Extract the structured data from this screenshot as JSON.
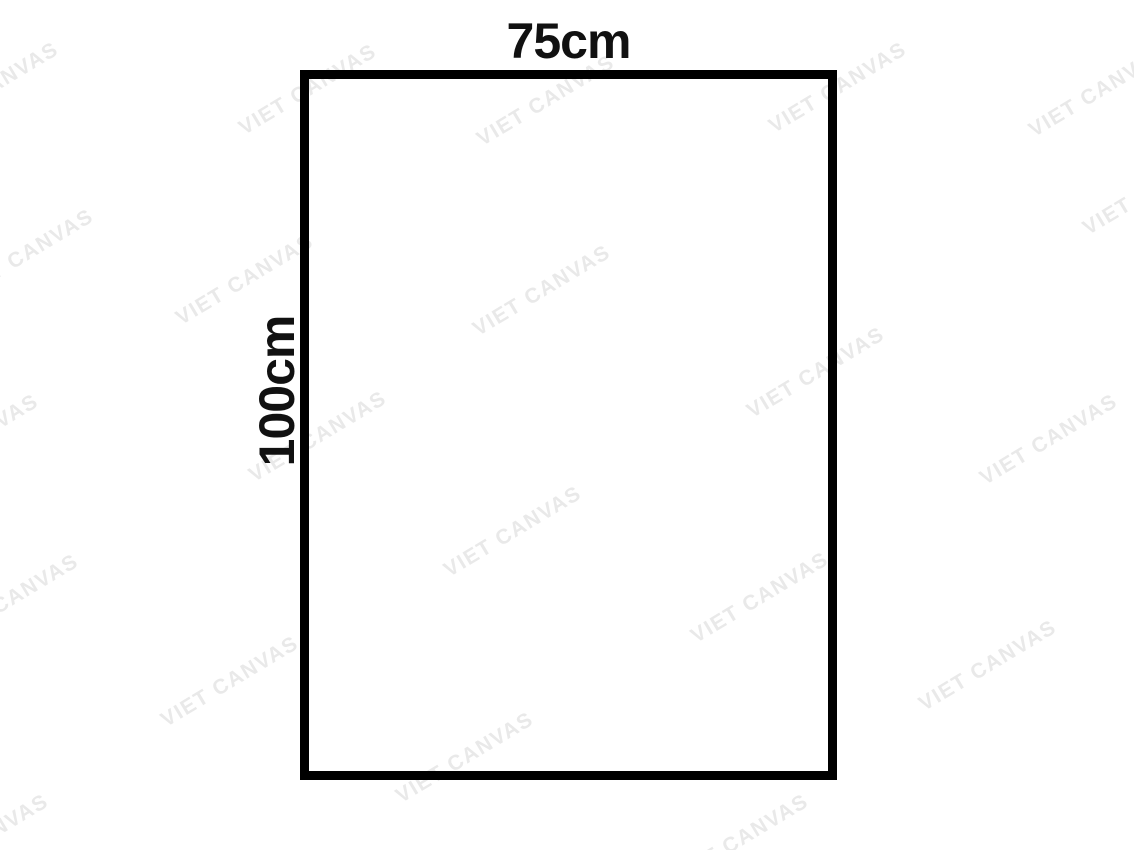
{
  "figure": {
    "type": "rectangle-dimension-diagram",
    "width_label": "75cm",
    "height_label": "100cm"
  },
  "watermark": {
    "text": "VIET CANVAS",
    "color": "#e9e9e9",
    "angle_deg": -31,
    "instances": [
      {
        "x": -10,
        "y": 88
      },
      {
        "x": 308,
        "y": 90
      },
      {
        "x": 546,
        "y": 101
      },
      {
        "x": 838,
        "y": 88
      },
      {
        "x": 1098,
        "y": 92
      },
      {
        "x": 1152,
        "y": 190
      },
      {
        "x": 25,
        "y": 255
      },
      {
        "x": 245,
        "y": 280
      },
      {
        "x": 542,
        "y": 291
      },
      {
        "x": 816,
        "y": 373
      },
      {
        "x": -30,
        "y": 440
      },
      {
        "x": 318,
        "y": 437
      },
      {
        "x": 1049,
        "y": 440
      },
      {
        "x": 513,
        "y": 532
      },
      {
        "x": 10,
        "y": 600
      },
      {
        "x": 760,
        "y": 598
      },
      {
        "x": 230,
        "y": 682
      },
      {
        "x": 988,
        "y": 666
      },
      {
        "x": 465,
        "y": 758
      },
      {
        "x": -20,
        "y": 840
      },
      {
        "x": 740,
        "y": 840
      }
    ]
  },
  "colors": {
    "background": "#ffffff",
    "border": "#000000",
    "label": "#111111"
  }
}
